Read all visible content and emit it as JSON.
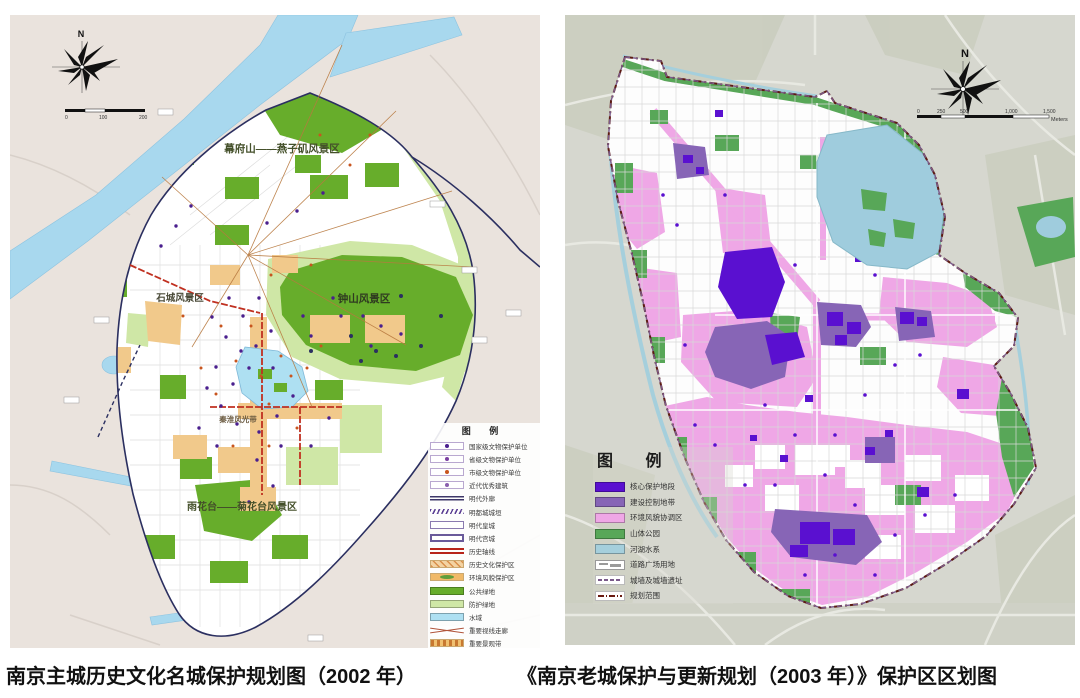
{
  "captions": {
    "left": "南京主城历史文化名城保护规划图（2002 年）",
    "right": "《南京老城保护与更新规划（2003 年）》保护区区划图"
  },
  "left_map": {
    "compass_n": "N",
    "scale": {
      "t0": "0",
      "t1": "100",
      "t2": "200"
    },
    "labels": {
      "mufushan": "幕府山——燕子矶风景区",
      "zhongshan": "钟山风景区",
      "shicheng": "石城风景区",
      "yuhuatai": "雨花台——菊花台风景区",
      "qinhuai": "秦淮风光带"
    },
    "legend": {
      "title": "图 例",
      "items": [
        {
          "label": "国家级文物保护单位",
          "type": "dot",
          "c1": "#ffffff",
          "c2": "#4a1f8e"
        },
        {
          "label": "省级文物保护单位",
          "type": "dot",
          "c1": "#ffffff",
          "c2": "#7a3fa0"
        },
        {
          "label": "市级文物保护单位",
          "type": "dot",
          "c1": "#ffffff",
          "c2": "#c8551e"
        },
        {
          "label": "近代优秀建筑",
          "type": "dot",
          "c1": "#ffffff",
          "c2": "#8a5fae"
        },
        {
          "label": "明代外廓",
          "type": "line",
          "c1": "#3d3668"
        },
        {
          "label": "明都城城垣",
          "type": "wavy",
          "c1": "#5b3f94"
        },
        {
          "label": "明代皇城",
          "type": "outline",
          "c1": "#8a7ab0"
        },
        {
          "label": "明代宫城",
          "type": "outline2",
          "c1": "#6a5a9a"
        },
        {
          "label": "历史轴线",
          "type": "dblline",
          "c1": "#b8241a"
        },
        {
          "label": "历史文化保护区",
          "type": "hatch",
          "c1": "#f3d3a2",
          "c2": "#d98f4a"
        },
        {
          "label": "环境风貌保护区",
          "type": "blob",
          "c1": "#f0b968",
          "c2": "#5f9e3a"
        },
        {
          "label": "公共绿地",
          "type": "fill",
          "c1": "#67ad2b"
        },
        {
          "label": "防护绿地",
          "type": "fill",
          "c1": "#cfe7a6"
        },
        {
          "label": "水域",
          "type": "fill",
          "c1": "#aee0f2"
        },
        {
          "label": "重要视线走廊",
          "type": "cross",
          "c1": "#b0543a"
        },
        {
          "label": "重要景观带",
          "type": "dashband",
          "c1": "#f0c070",
          "c2": "#c87830"
        }
      ]
    }
  },
  "right_map": {
    "compass_n": "N",
    "scale": {
      "t0": "0",
      "t1": "250",
      "t2": "500",
      "t3": "1,000",
      "t4": "1,500",
      "unit": "Meters"
    },
    "legend": {
      "title": "图 例",
      "items": [
        {
          "label": "核心保护地段",
          "type": "fill",
          "c1": "#5a10d0"
        },
        {
          "label": "建设控制地带",
          "type": "fill",
          "c1": "#8765b6"
        },
        {
          "label": "环境风貌协调区",
          "type": "fill",
          "c1": "#efa7e6"
        },
        {
          "label": "山体公园",
          "type": "fill",
          "c1": "#58a758"
        },
        {
          "label": "河湖水系",
          "type": "fill",
          "c1": "#a5cfdc"
        },
        {
          "label": "道路广场用地",
          "type": "road",
          "c1": "#ffffff",
          "c2": "#9a9a9a"
        },
        {
          "label": "城墙及城墙遗址",
          "type": "wall",
          "c1": "#7a5a8a"
        },
        {
          "label": "规划范围",
          "type": "boundary",
          "c1": "#6a1a10"
        }
      ]
    }
  }
}
